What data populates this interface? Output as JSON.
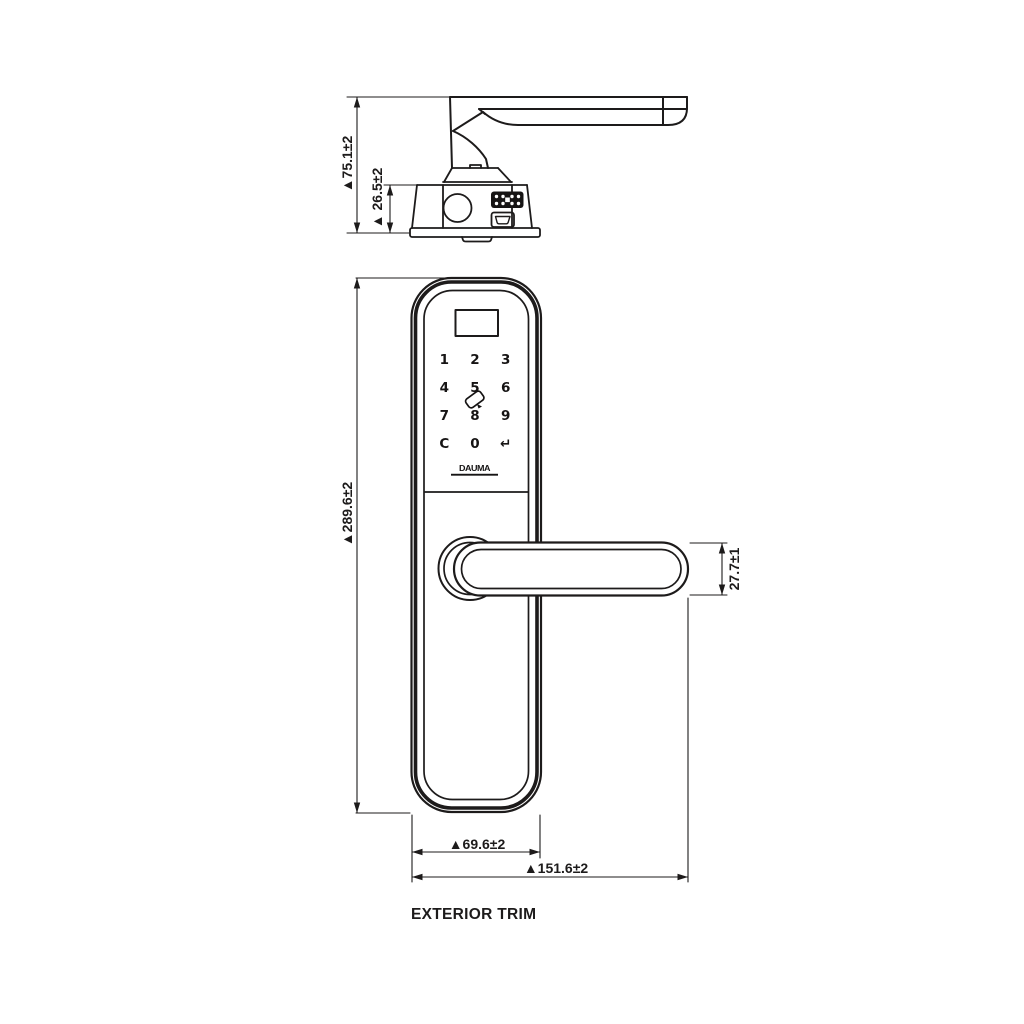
{
  "page": {
    "background": "#ffffff",
    "line_color": "#1d1b1b"
  },
  "title": "EXTERIOR TRIM",
  "side_view": {
    "dim_total_height": "▲75.1±2",
    "dim_base_height": "▲ 26.5±2"
  },
  "front_view": {
    "dim_body_height": "▲289.6±2",
    "dim_lever_thickness": "27.7±1",
    "dim_body_width": "▲69.6±2",
    "dim_total_width": "▲151.6±2",
    "brand_logo": "DAUMA",
    "keypad_keys": [
      "1",
      "2",
      "3",
      "4",
      "5",
      "6",
      "7",
      "8",
      "9",
      "C",
      "0",
      "↵"
    ]
  }
}
